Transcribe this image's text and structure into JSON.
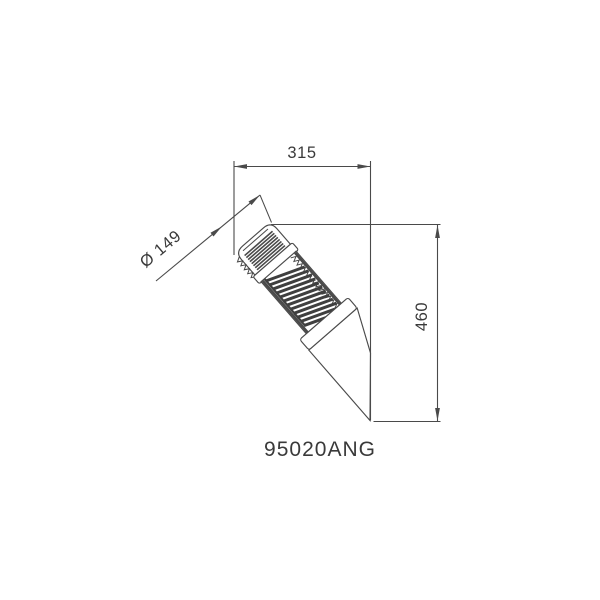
{
  "drawing": {
    "product_code": "95020ANG",
    "dimensions": {
      "width": "315",
      "diameter": "Ø 149",
      "height": "460"
    },
    "colors": {
      "line": "#4a4a4a",
      "text": "#3a3a3a",
      "slat": "#3f3f3f",
      "background": "#ffffff"
    }
  }
}
